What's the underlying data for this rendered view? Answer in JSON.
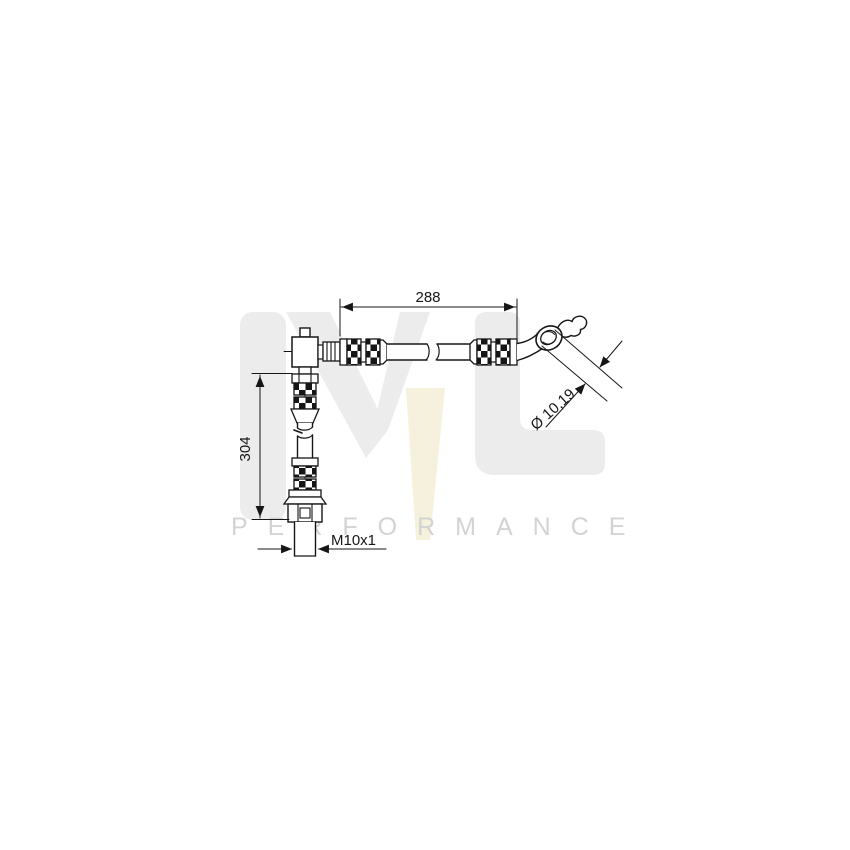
{
  "drawing": {
    "title": "brake hose technical drawing",
    "dim_length_horizontal": "288",
    "dim_length_vertical": "304",
    "dim_eye_diameter": "Ø 10,19",
    "dim_thread": "M10x1",
    "line_color": "#161616"
  },
  "watermark": {
    "monogram_m": "M",
    "monogram_l": "L",
    "subtext": "PERFORMANCE",
    "monogram_color": "#ececec",
    "accent_color": "#f5f1dd",
    "subtext_color": "#d3d3d3"
  }
}
